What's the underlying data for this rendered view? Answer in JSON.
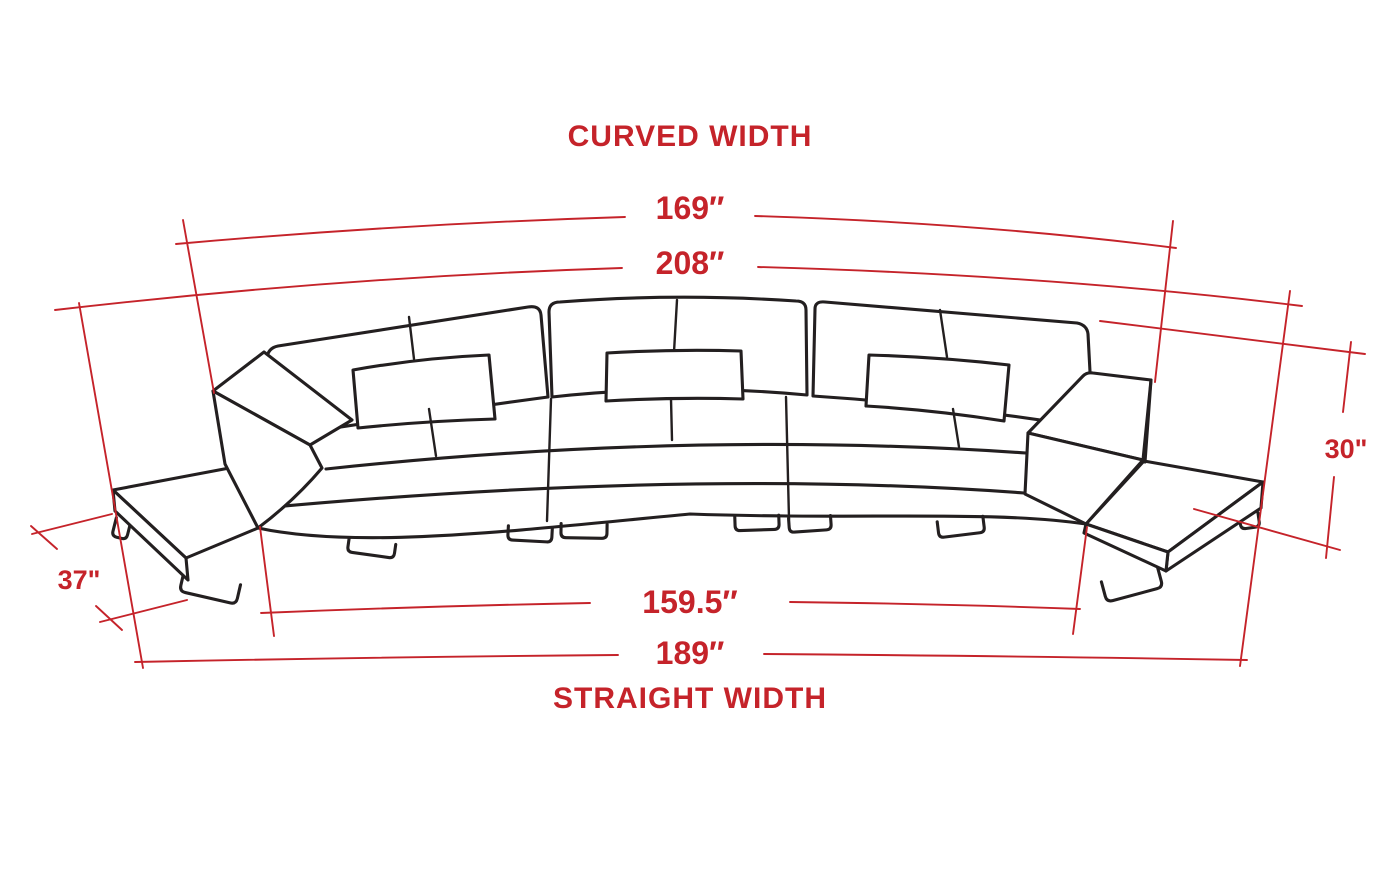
{
  "diagram": {
    "top_title": "CURVED WIDTH",
    "bottom_title": "STRAIGHT WIDTH",
    "measurements": {
      "curved_width_inner": "169″",
      "curved_width_outer": "208″",
      "back_height": "30\"",
      "end_table_depth": "37\"",
      "straight_width_inner": "159.5″",
      "straight_width_outer": "189″"
    },
    "colors": {
      "annotation": "#c5232a",
      "line_art": "#231f20",
      "background": "#ffffff"
    },
    "illustration": "curved-three-seat-sectional-sofa-line-drawing"
  }
}
